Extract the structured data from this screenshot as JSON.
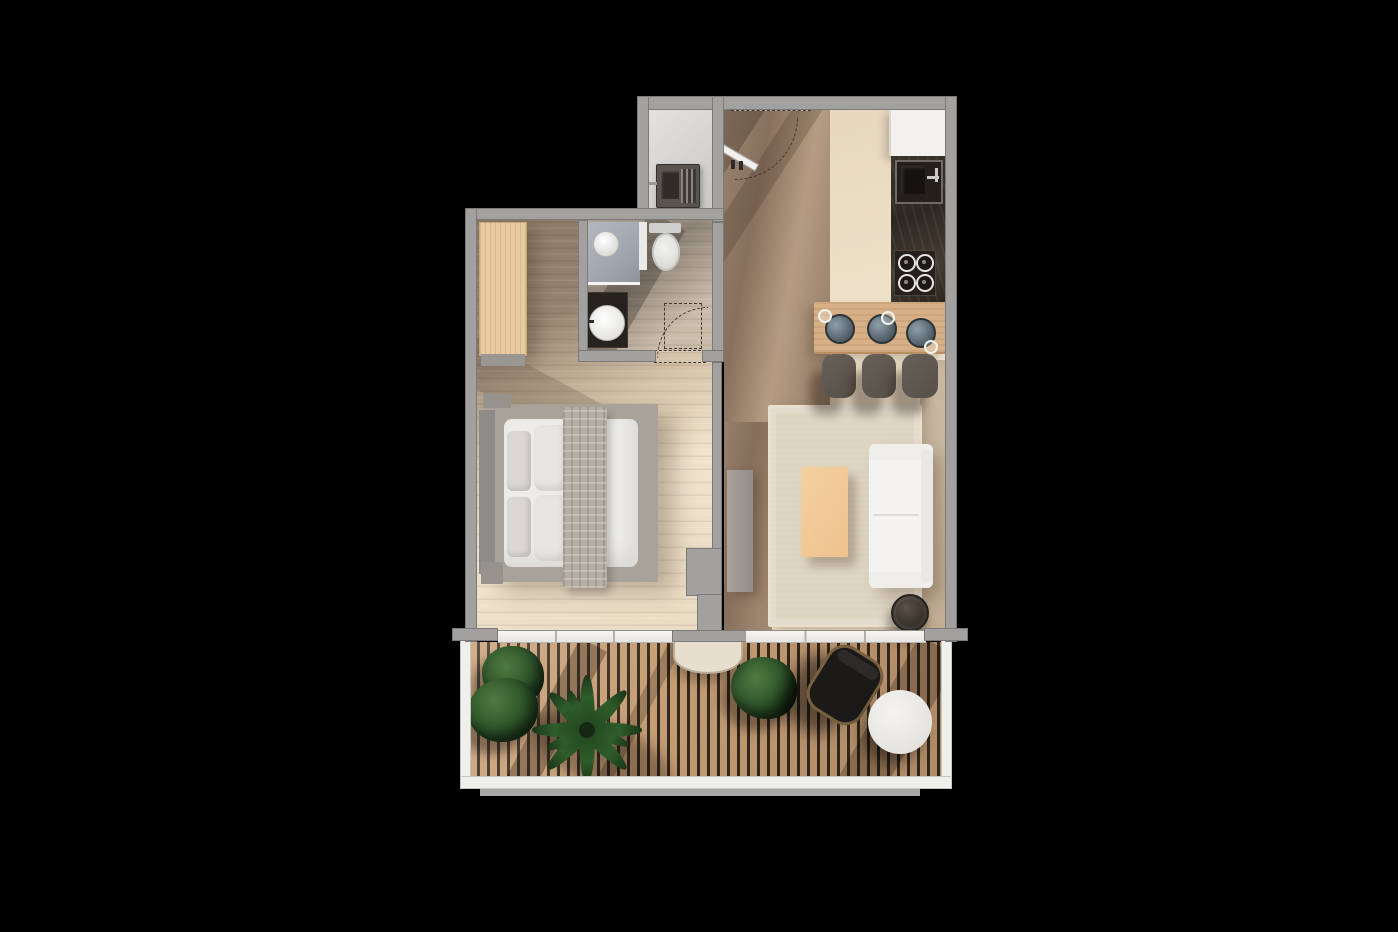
{
  "scene": {
    "type": "apartment-floor-plan-top-view",
    "description": "Top-down 3D rendered floor plan of a one-bedroom apartment with balcony, on black background",
    "background": "#000000"
  },
  "palette": {
    "bg": "#000000",
    "wall": "#a2a19f",
    "wallEdge": "#7b7a78",
    "dash": "#3f372e",
    "tile": "#eee0c9",
    "wood": "#947e6a",
    "nicheFloor": "#d9d8d5",
    "bathFloor": "#9c9186",
    "deck": "#c69d74",
    "deckGap": "#33281e",
    "railing": "#efefec",
    "doorFrame": "#f2f1ee",
    "wardrobe": "#e8cba0",
    "barWood": "#d7b086",
    "counterDark": "#2e2823",
    "cabinetWhite": "#f1f0ed",
    "rug": "#ded4c2",
    "sofa": "#f5f4f2",
    "coffeeTable": "#eec28c",
    "sideTable": "#3a342d",
    "mattress": "#edece8",
    "pillow": "#dbd8d3",
    "blanket": "#b5aea4",
    "platform": "#a8a29a",
    "headboard": "#8e8c88",
    "shower": "#a0a6ae",
    "fixtureWhite": "#f2f2f0",
    "vanity": "#26221e",
    "plant": "#2c5128",
    "plantDark": "#1b351a",
    "chair": "#1b1a18",
    "wicker": "#77603f",
    "bowl": "#59656e",
    "stool": "#57504a",
    "console": "#a09890",
    "semiTable": "#e8decd"
  },
  "rooms": [
    {
      "name": "entry-hall",
      "floor": "wood-look-tile",
      "features": [
        "entrance-door-swing",
        "dashed-shaft-marker"
      ]
    },
    {
      "name": "utility-niche",
      "floor": "light-grey",
      "features": [
        "utility-sink-unit",
        "drying-rack"
      ]
    },
    {
      "name": "kitchen",
      "floor": "beige-tile",
      "features": [
        "tall-white-cabinet",
        "dark-stone-counter",
        "kitchen-sink",
        "four-burner-cooktop",
        "breakfast-bar"
      ]
    },
    {
      "name": "bathroom",
      "floor": "grey-stone-tile",
      "features": [
        "shower-with-glass-screen",
        "toilet",
        "dark-vanity",
        "round-basin",
        "inward-door-swing"
      ]
    },
    {
      "name": "bedroom",
      "floor": "travertine-tile",
      "features": [
        "wardrobe",
        "double-bed",
        "headboard",
        "pillows",
        "plaid-throw",
        "nightstands"
      ]
    },
    {
      "name": "living-room",
      "floor": "travertine-tile",
      "features": [
        "area-rug",
        "coffee-table",
        "white-sofa",
        "round-side-table",
        "tv-console"
      ]
    },
    {
      "name": "balcony",
      "floor": "wood-slat-deck",
      "features": [
        "white-railing",
        "semicircle-table",
        "lounge-chair",
        "round-white-table",
        "potted-plants"
      ]
    }
  ],
  "counts": {
    "bar_stools": 3,
    "bar_bowls": 3,
    "bar_glasses": 3,
    "balcony_plants": 4,
    "sliding_door_panels": 2,
    "door_swings": 3
  },
  "lighting": {
    "sun_shadows": "diagonal shadows cast across entry, bathroom, bedroom and balcony",
    "direction": "upper-left"
  }
}
